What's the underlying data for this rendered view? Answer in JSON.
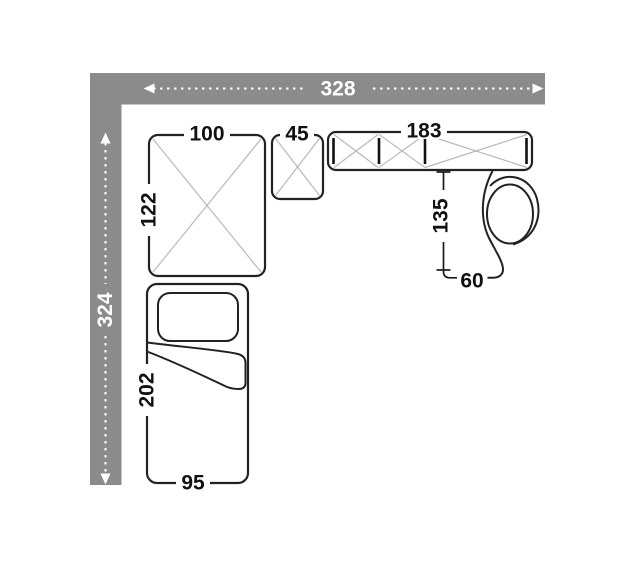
{
  "colors": {
    "wall": "#8b8b8b",
    "outline": "#222222",
    "cross_lines": "#b9b9b9",
    "label_text": "#111111",
    "wall_label_text": "#ffffff",
    "background": "#ffffff"
  },
  "room": {
    "width": "328",
    "depth": "324"
  },
  "furniture": {
    "large_seat": {
      "width": "100",
      "depth": "122"
    },
    "small_seat": {
      "width": "45"
    },
    "sofa": {
      "width": "183"
    },
    "chair_zone": {
      "depth": "135",
      "width": "60"
    },
    "bed": {
      "length": "202",
      "width": "95"
    }
  }
}
